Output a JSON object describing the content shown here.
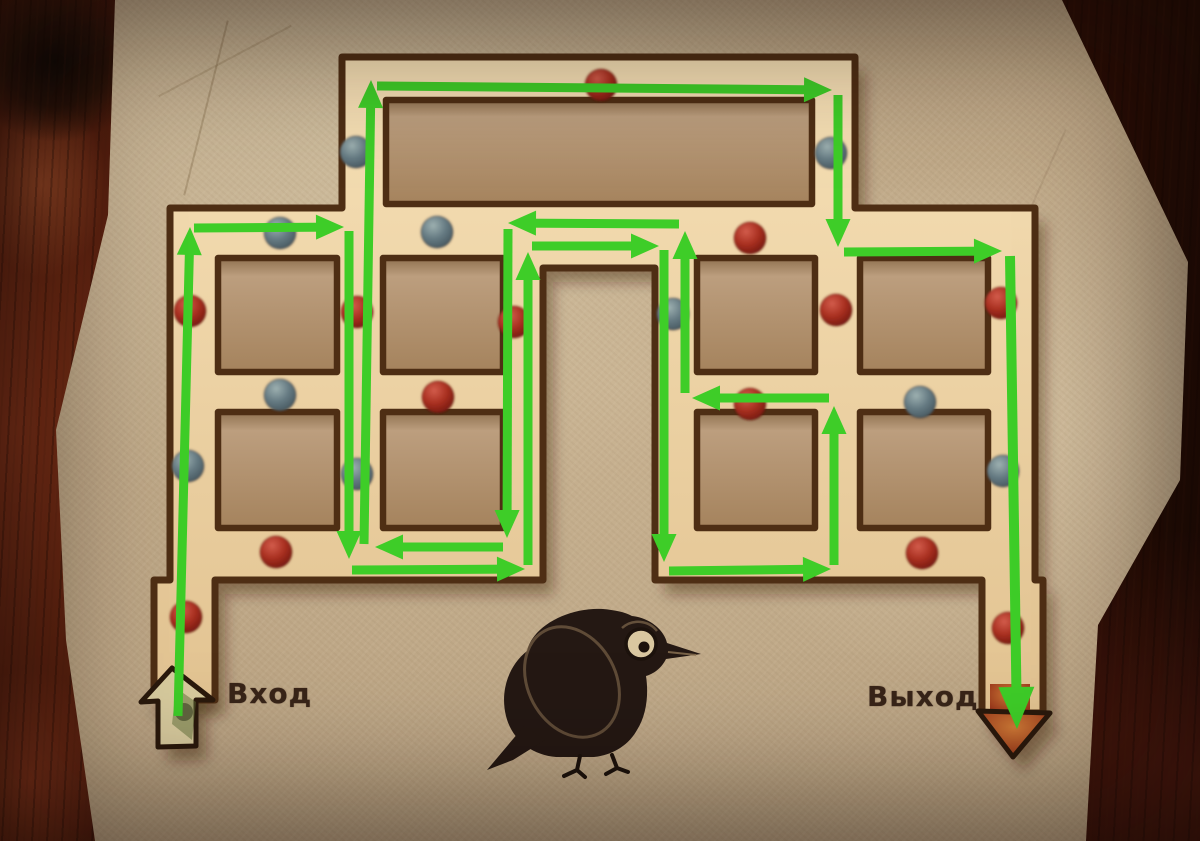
{
  "labels": {
    "entrance": "Вход",
    "exit": "Выход"
  },
  "icons": {
    "entrance": "up-arrow-icon",
    "exit": "down-arrow-icon",
    "mascot": "crow-icon",
    "beads": [
      "red-bead-icon",
      "blue-bead-icon"
    ]
  },
  "colors": {
    "path_green": "#3ecd28",
    "wall_brown": "#4e2e14",
    "corridor_light": "#f6e0b6",
    "corridor_dark": "#e2c391",
    "island_light": "#bc9e7e",
    "island_dark": "#a5835d",
    "island_shadow": "#8f7150",
    "paper_tan": "#c2ac8a",
    "wood_dark": "#4a160b",
    "dot_red_light": "#d25c4b",
    "dot_red": "#a93021",
    "dot_red_dark": "#6e150c",
    "dot_blue_light": "#9db0b0",
    "dot_blue": "#667b83",
    "dot_blue_dark": "#41525a",
    "exit_orange": "#cf7a36",
    "exit_red": "#8a2413",
    "entrance_cream": "#d8cb9e",
    "entrance_moss": "#5d6e35",
    "text_brown": "#382418",
    "shadow": "rgba(52,26,10,0.42)"
  },
  "maze": {
    "outline": [
      [
        342,
        57
      ],
      [
        855,
        57
      ],
      [
        855,
        208
      ],
      [
        1035,
        208
      ],
      [
        1035,
        580
      ],
      [
        1043,
        580
      ],
      [
        1043,
        713
      ],
      [
        982,
        713
      ],
      [
        982,
        580
      ],
      [
        655,
        580
      ],
      [
        655,
        268
      ],
      [
        543,
        268
      ],
      [
        543,
        580
      ],
      [
        215,
        580
      ],
      [
        215,
        700
      ],
      [
        154,
        700
      ],
      [
        154,
        580
      ],
      [
        170,
        580
      ],
      [
        170,
        208
      ],
      [
        342,
        208
      ]
    ],
    "islands": [
      {
        "x": 386,
        "y": 100,
        "w": 426,
        "h": 104
      },
      {
        "x": 218,
        "y": 258,
        "w": 119,
        "h": 114
      },
      {
        "x": 383,
        "y": 258,
        "w": 120,
        "h": 114
      },
      {
        "x": 697,
        "y": 258,
        "w": 118,
        "h": 114
      },
      {
        "x": 860,
        "y": 258,
        "w": 128,
        "h": 114
      },
      {
        "x": 218,
        "y": 412,
        "w": 119,
        "h": 116
      },
      {
        "x": 383,
        "y": 412,
        "w": 120,
        "h": 116
      },
      {
        "x": 697,
        "y": 412,
        "w": 118,
        "h": 116
      },
      {
        "x": 860,
        "y": 412,
        "w": 128,
        "h": 116
      }
    ]
  },
  "dots": [
    {
      "color": "red",
      "x": 601,
      "y": 85
    },
    {
      "color": "blue",
      "x": 356,
      "y": 152
    },
    {
      "color": "blue",
      "x": 831,
      "y": 153
    },
    {
      "color": "blue",
      "x": 280,
      "y": 233
    },
    {
      "color": "blue",
      "x": 437,
      "y": 232
    },
    {
      "color": "red",
      "x": 750,
      "y": 238
    },
    {
      "color": "red",
      "x": 190,
      "y": 311
    },
    {
      "color": "red",
      "x": 357,
      "y": 312
    },
    {
      "color": "red",
      "x": 514,
      "y": 322
    },
    {
      "color": "blue",
      "x": 673,
      "y": 314
    },
    {
      "color": "red",
      "x": 836,
      "y": 310
    },
    {
      "color": "red",
      "x": 1001,
      "y": 303
    },
    {
      "color": "blue",
      "x": 280,
      "y": 395
    },
    {
      "color": "red",
      "x": 438,
      "y": 397
    },
    {
      "color": "red",
      "x": 750,
      "y": 404
    },
    {
      "color": "blue",
      "x": 920,
      "y": 402
    },
    {
      "color": "blue",
      "x": 188,
      "y": 466
    },
    {
      "color": "blue",
      "x": 357,
      "y": 474
    },
    {
      "color": "blue",
      "x": 1003,
      "y": 471
    },
    {
      "color": "red",
      "x": 276,
      "y": 552
    },
    {
      "color": "red",
      "x": 922,
      "y": 553
    },
    {
      "color": "red",
      "x": 186,
      "y": 617
    },
    {
      "color": "red",
      "x": 1008,
      "y": 628
    }
  ],
  "solution_path": {
    "segments": [
      {
        "x1": 178,
        "y1": 716,
        "x2": 190,
        "y2": 227
      },
      {
        "x1": 194,
        "y1": 228,
        "x2": 344,
        "y2": 227
      },
      {
        "x1": 349,
        "y1": 231,
        "x2": 349,
        "y2": 559
      },
      {
        "x1": 352,
        "y1": 570,
        "x2": 525,
        "y2": 569
      },
      {
        "x1": 528,
        "y1": 565,
        "x2": 528,
        "y2": 252
      },
      {
        "x1": 532,
        "y1": 246,
        "x2": 659,
        "y2": 246
      },
      {
        "x1": 664,
        "y1": 250,
        "x2": 664,
        "y2": 562
      },
      {
        "x1": 669,
        "y1": 571,
        "x2": 831,
        "y2": 569
      },
      {
        "x1": 834,
        "y1": 565,
        "x2": 834,
        "y2": 406
      },
      {
        "x1": 829,
        "y1": 398,
        "x2": 692,
        "y2": 398
      },
      {
        "x1": 685,
        "y1": 393,
        "x2": 685,
        "y2": 231
      },
      {
        "x1": 679,
        "y1": 224,
        "x2": 508,
        "y2": 223
      },
      {
        "x1": 508,
        "y1": 229,
        "x2": 507,
        "y2": 538
      },
      {
        "x1": 503,
        "y1": 547,
        "x2": 375,
        "y2": 547
      },
      {
        "x1": 364,
        "y1": 544,
        "x2": 371,
        "y2": 80
      },
      {
        "x1": 377,
        "y1": 86,
        "x2": 832,
        "y2": 90
      },
      {
        "x1": 838,
        "y1": 95,
        "x2": 838,
        "y2": 247
      },
      {
        "x1": 844,
        "y1": 252,
        "x2": 1002,
        "y2": 251
      },
      {
        "x1": 1010,
        "y1": 256,
        "x2": 1017,
        "y2": 729,
        "big": true
      }
    ]
  },
  "gates": {
    "entrance_arrow": {
      "points": [
        [
          172,
          668
        ],
        [
          213,
          700
        ],
        [
          196,
          700
        ],
        [
          196,
          746
        ],
        [
          158,
          747
        ],
        [
          158,
          701
        ],
        [
          141,
          702
        ]
      ]
    },
    "exit_arrow": {
      "head": [
        [
          978,
          711
        ],
        [
          1050,
          713
        ],
        [
          1013,
          757
        ]
      ],
      "shaft": {
        "x": 990,
        "y": 684,
        "w": 40,
        "h": 30
      }
    }
  }
}
